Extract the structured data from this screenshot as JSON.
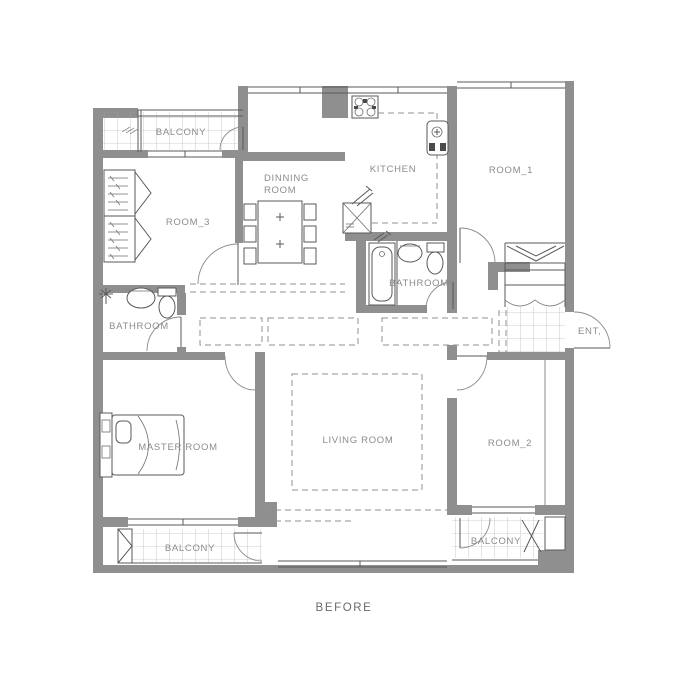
{
  "drawing": {
    "type": "floor-plan",
    "footer_label": "BEFORE",
    "colors": {
      "wall": "#8f8f8f",
      "line": "#5a5a5a",
      "dashed": "#909090",
      "label": "#8c8c8c",
      "background": "#ffffff"
    },
    "rooms": {
      "balcony_top": {
        "label": "BALCONY"
      },
      "room_3": {
        "label": "ROOM_3"
      },
      "dinning_room": {
        "label_line1": "DINNING",
        "label_line2": "ROOM"
      },
      "kitchen": {
        "label": "KITCHEN"
      },
      "room_1": {
        "label": "ROOM_1"
      },
      "bathroom_center": {
        "label": "BATHROOM"
      },
      "bathroom_left": {
        "label": "BATHROOM"
      },
      "entrance": {
        "label": "ENT,"
      },
      "master_room": {
        "label": "MASTER ROOM"
      },
      "living_room": {
        "label": "LIVING ROOM"
      },
      "room_2": {
        "label": "ROOM_2"
      },
      "balcony_bottom_left": {
        "label": "BALCONY"
      },
      "balcony_bottom_right": {
        "label": "BALCONY"
      }
    }
  }
}
